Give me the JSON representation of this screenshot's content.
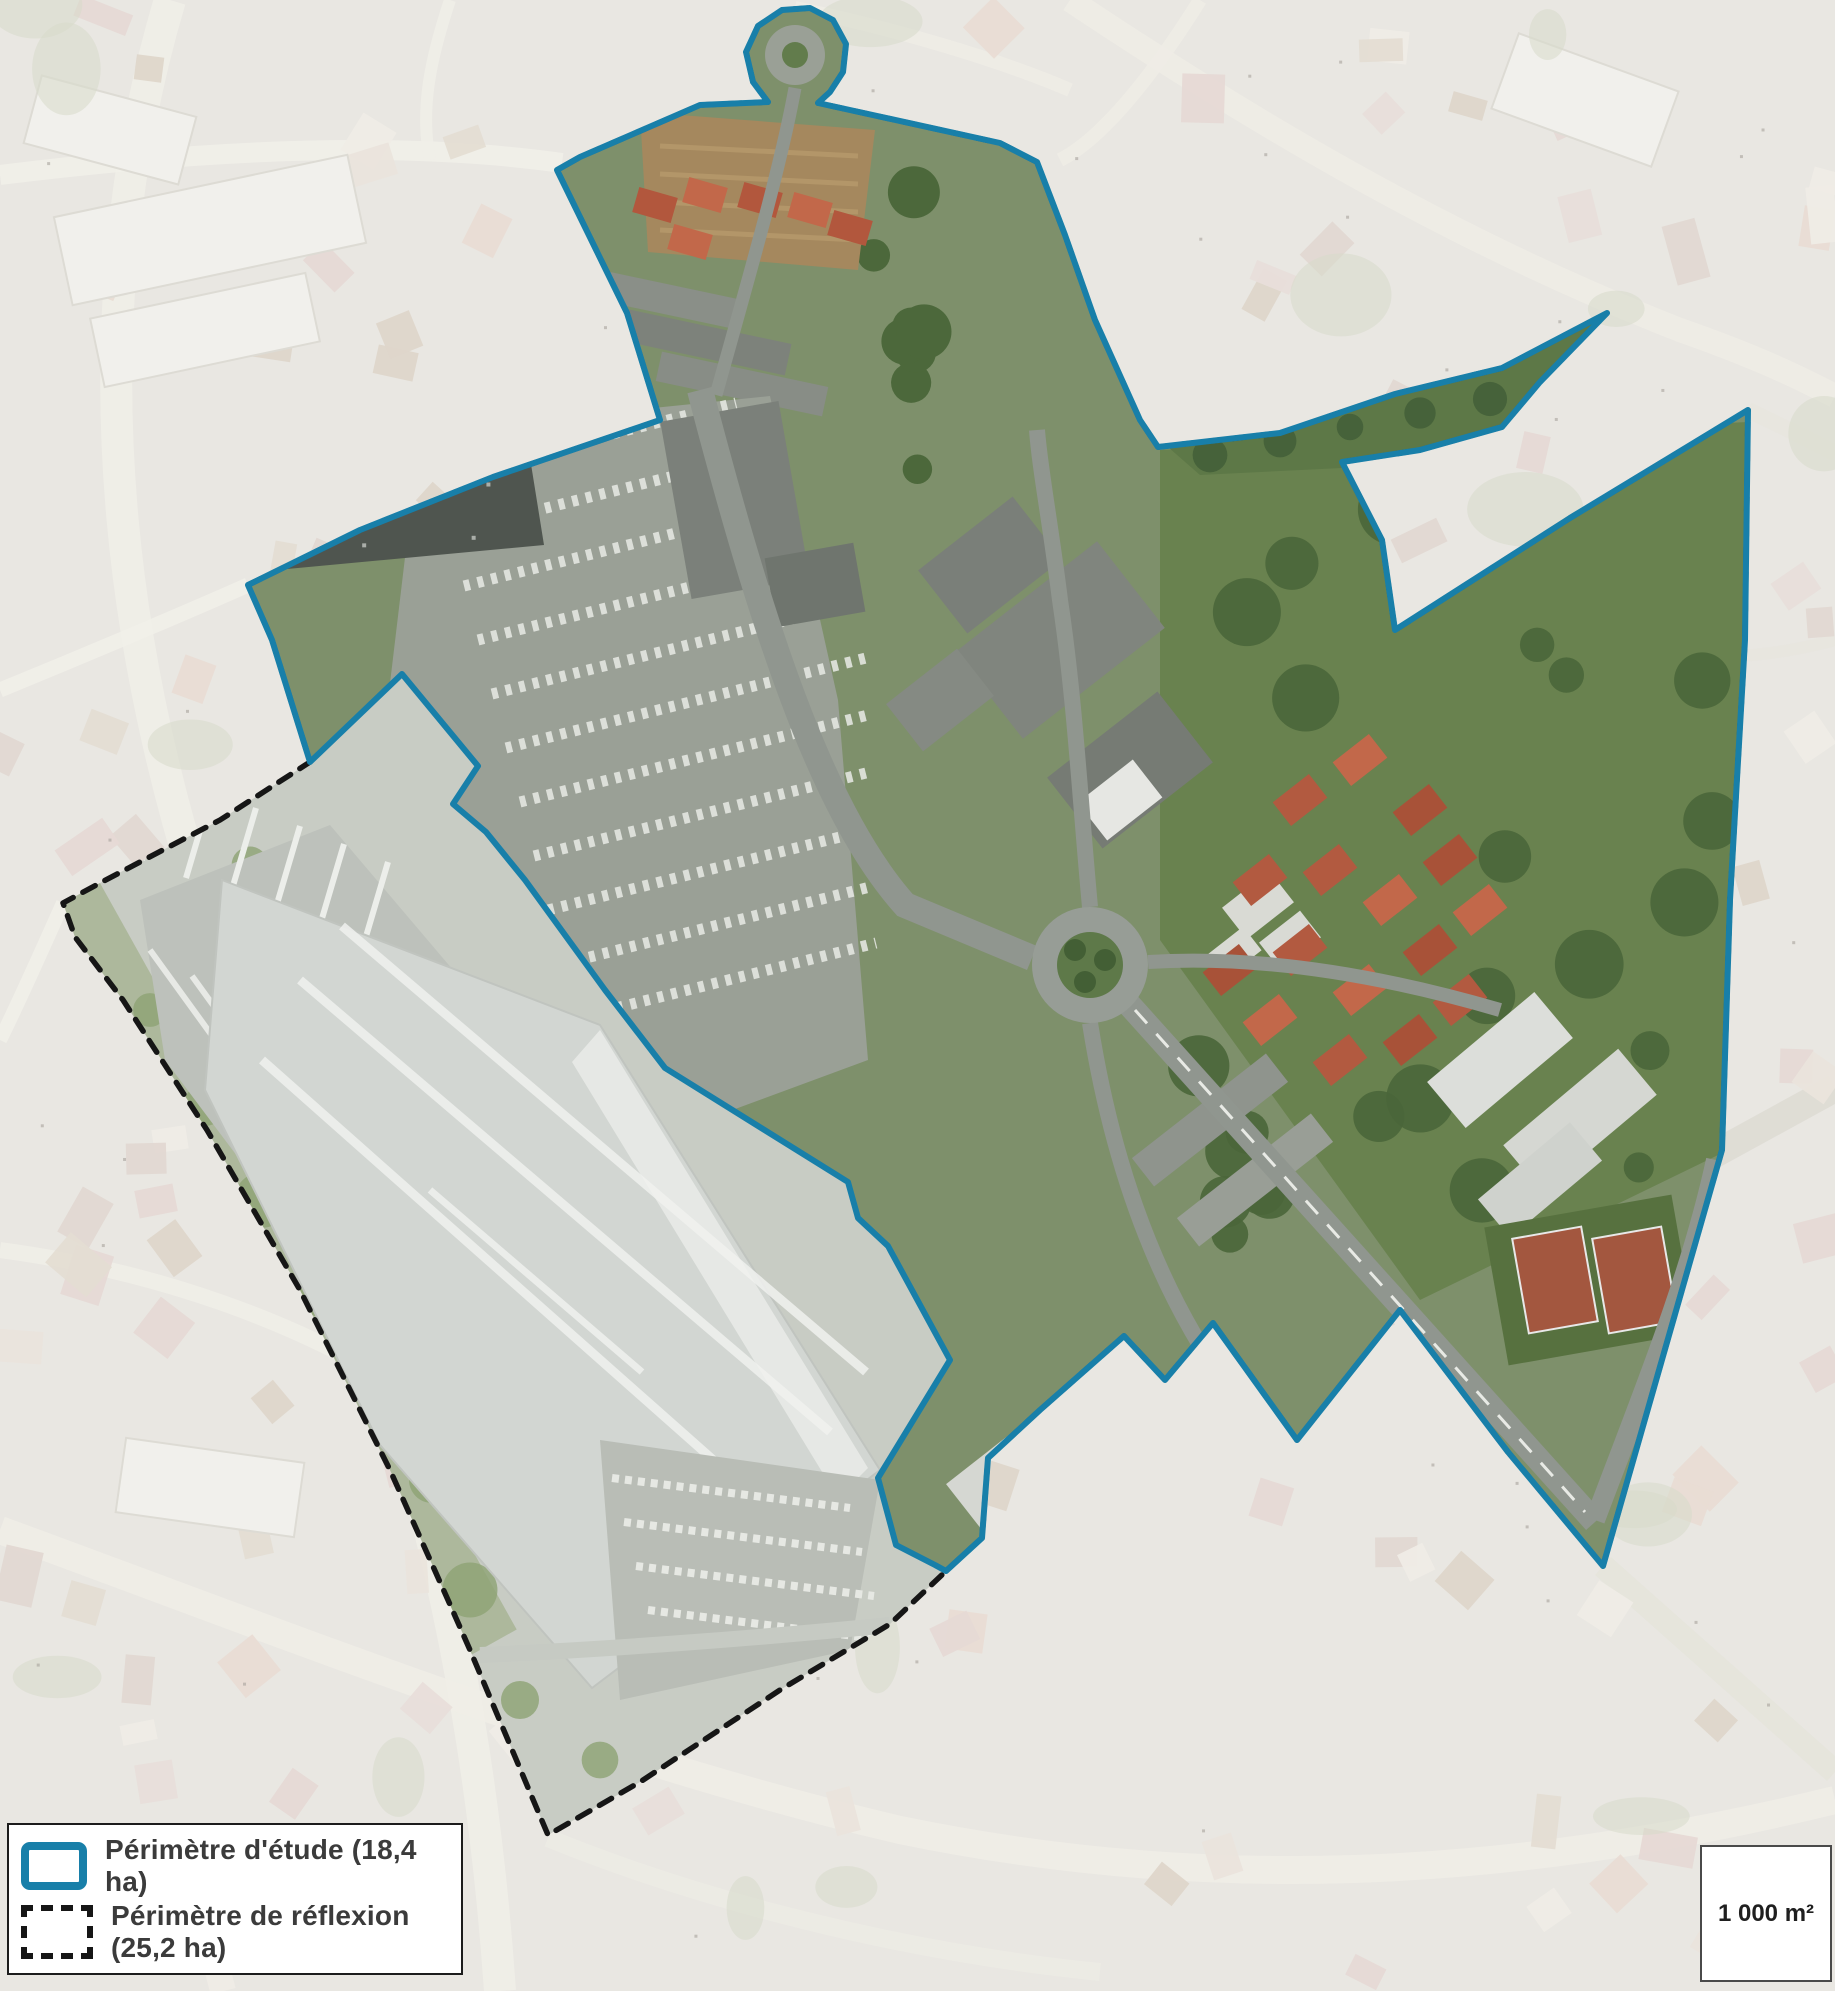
{
  "legend": {
    "items": [
      {
        "id": "study",
        "label": "Périmètre d'étude (18,4 ha)",
        "swatch": "blue-solid-outline"
      },
      {
        "id": "reflexion",
        "label": "Périmètre de réflexion (25,2 ha)",
        "swatch": "black-dashed-outline"
      }
    ]
  },
  "scale_box": {
    "label": "1 000 m²"
  },
  "colors": {
    "study_outline": "#187fa9",
    "reflection_outline": "#161616",
    "legend_border": "#1c1c1c"
  }
}
